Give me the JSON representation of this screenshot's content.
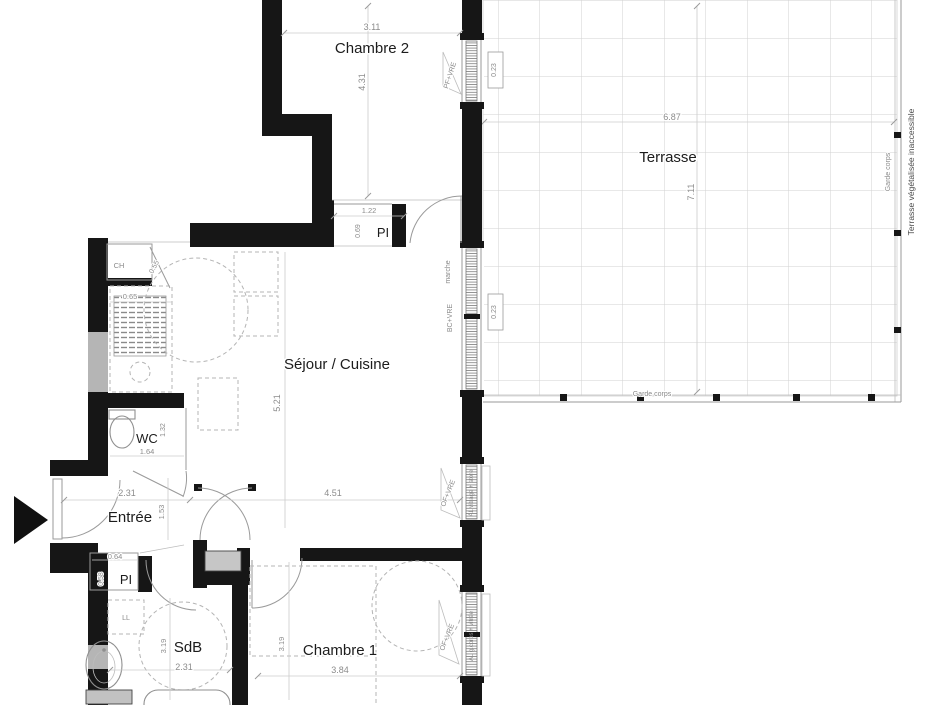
{
  "plan": {
    "rooms": {
      "chambre2": {
        "label": "Chambre 2",
        "width_m": "3.11",
        "height_m": "4.31"
      },
      "terrasse": {
        "label": "Terrasse",
        "width_m": "6.87",
        "height_m": "7.11",
        "railing_bottom_label": "Garde corps",
        "railing_right_label": "Garde corps",
        "note": "Terrasse végétalisée inaccessible",
        "threshold_top": "0.23",
        "threshold_mid": "0.23"
      },
      "sejour_cuisine": {
        "label": "Séjour / Cuisine",
        "width_m": "4.51",
        "height_m": "5.21"
      },
      "entree": {
        "label": "Entrée",
        "width_m": "2.31",
        "height_m": "1.53"
      },
      "wc": {
        "label": "WC",
        "width_m": "1.64",
        "height_m": "1.32"
      },
      "sdb": {
        "label": "SdB",
        "width_m": "2.31",
        "height_m": "3.19",
        "washer_label": "LL"
      },
      "chambre1": {
        "label": "Chambre 1",
        "width_m": "3.84",
        "height_m": "3.19"
      },
      "chaufferie": {
        "label": "CH",
        "width_m": "0.65",
        "door_m": "0.55"
      },
      "placard_sejour": {
        "label": "PI",
        "width_m": "1.22",
        "depth_m": "0.69"
      },
      "placard_entree": {
        "label": "PI",
        "width_m": "0.64",
        "depth_m": "0.58"
      }
    },
    "openings": {
      "window_chambre2": {
        "label": "PF+VRE"
      },
      "bay_sejour": {
        "label": "BC+VRE",
        "step_label": "marche"
      },
      "window_sejour": {
        "label": "OF+VRE",
        "sill_label": "AL vitrage + store"
      },
      "window_chambre1": {
        "label": "OF+VRE",
        "sill_label": "AL g.corps + vitrée"
      }
    },
    "colors": {
      "wall": "#161616",
      "wall_insulation": "#b5b5b5",
      "room_text": "#1c1c1c",
      "dim_text": "#8c8c8c",
      "grid": "#d2d2d2",
      "fixture": "#8f8f8f"
    }
  }
}
